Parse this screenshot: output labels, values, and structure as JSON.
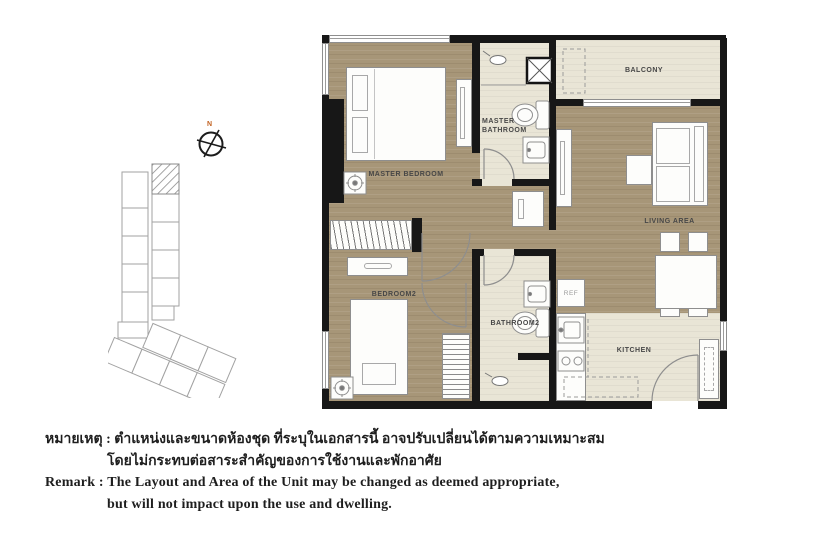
{
  "compass": {
    "north_label": "N"
  },
  "floor_plan": {
    "labels": {
      "master_bedroom": "MASTER BEDROOM",
      "master_bathroom_line1": "MASTER",
      "master_bathroom_line2": "BATHROOM",
      "balcony": "BALCONY",
      "living_area": "LIVING AREA",
      "bedroom2": "BEDROOM2",
      "bathroom2": "BATHROOM2",
      "kitchen": "KITCHEN",
      "refrigerator": "REF"
    },
    "colors": {
      "wood_floor": "#a79678",
      "tile_floor": "#e9e5d6",
      "wall": "#171717"
    }
  },
  "remarks": {
    "thai_line1": "หมายเหตุ : ตำแหน่งและขนาดห้องชุด ที่ระบุในเอกสารนี้ อาจปรับเปลี่ยนได้ตามความเหมาะสม",
    "thai_line2": "โดยไม่กระทบต่อสาระสำคัญของการใช้งานและพักอาศัย",
    "english_line1": "Remark : The Layout and Area of the Unit may be changed as deemed appropriate,",
    "english_line2": "but will not impact upon the use and dwelling."
  }
}
